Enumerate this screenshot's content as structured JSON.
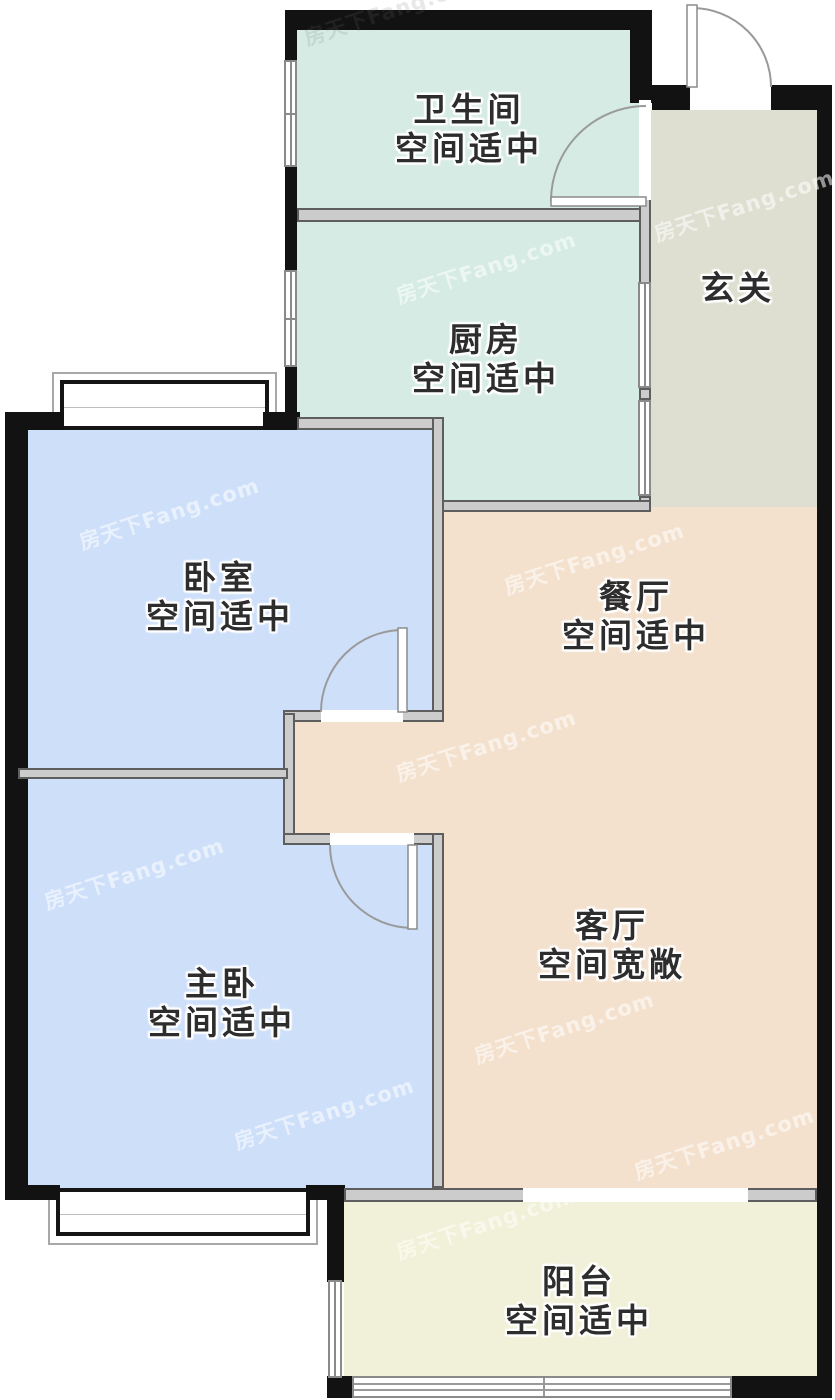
{
  "rooms": {
    "bathroom": {
      "name": "卫生间",
      "desc": "空间适中"
    },
    "kitchen": {
      "name": "厨房",
      "desc": "空间适中"
    },
    "entrance": {
      "name": "玄关",
      "desc": ""
    },
    "bedroom": {
      "name": "卧室",
      "desc": "空间适中"
    },
    "dining": {
      "name": "餐厅",
      "desc": "空间适中"
    },
    "master": {
      "name": "主卧",
      "desc": "空间适中"
    },
    "living": {
      "name": "客厅",
      "desc": "空间宽敞"
    },
    "balcony": {
      "name": "阳台",
      "desc": "空间适中"
    }
  },
  "colors": {
    "wet_block": "#d5ebe4",
    "entrance": "#dedfd1",
    "dining_living": "#f3e1ce",
    "bedrooms": "#cedffa",
    "balcony": "#f1f0d8",
    "wall_black": "#121212",
    "wall_gray": "#cccccc",
    "wall_gray_edge": "#5e5e5e",
    "door_arc": "#9a9a9a"
  },
  "watermark": {
    "text": "房天下Fang.com"
  }
}
